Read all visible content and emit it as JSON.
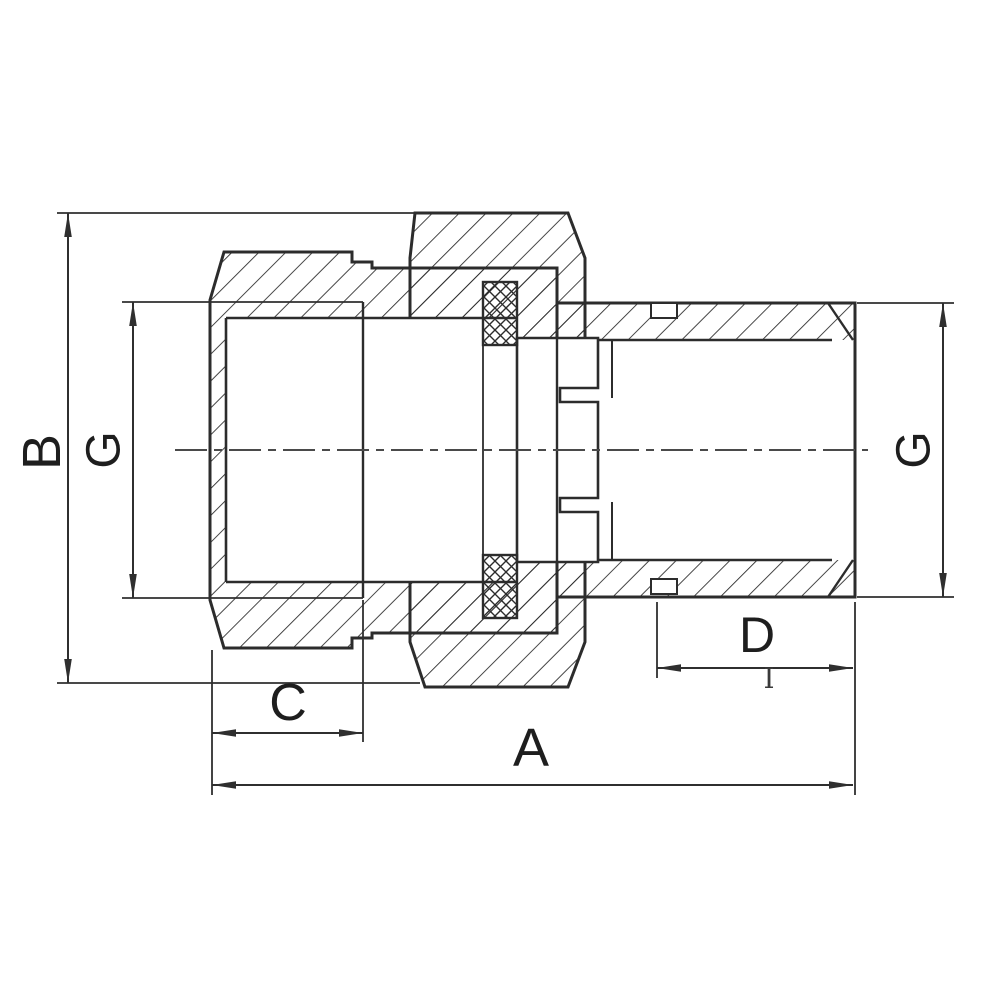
{
  "labels": {
    "overall_length": "A",
    "overall_height": "B",
    "nut_depth": "C",
    "thread_length": "D",
    "thread_size_left": "G",
    "thread_size_right": "G"
  },
  "artifact_text": "I",
  "colors": {
    "line": "#2c2c2c",
    "dimension": "#2f2f2f",
    "background": "#ffffff"
  }
}
